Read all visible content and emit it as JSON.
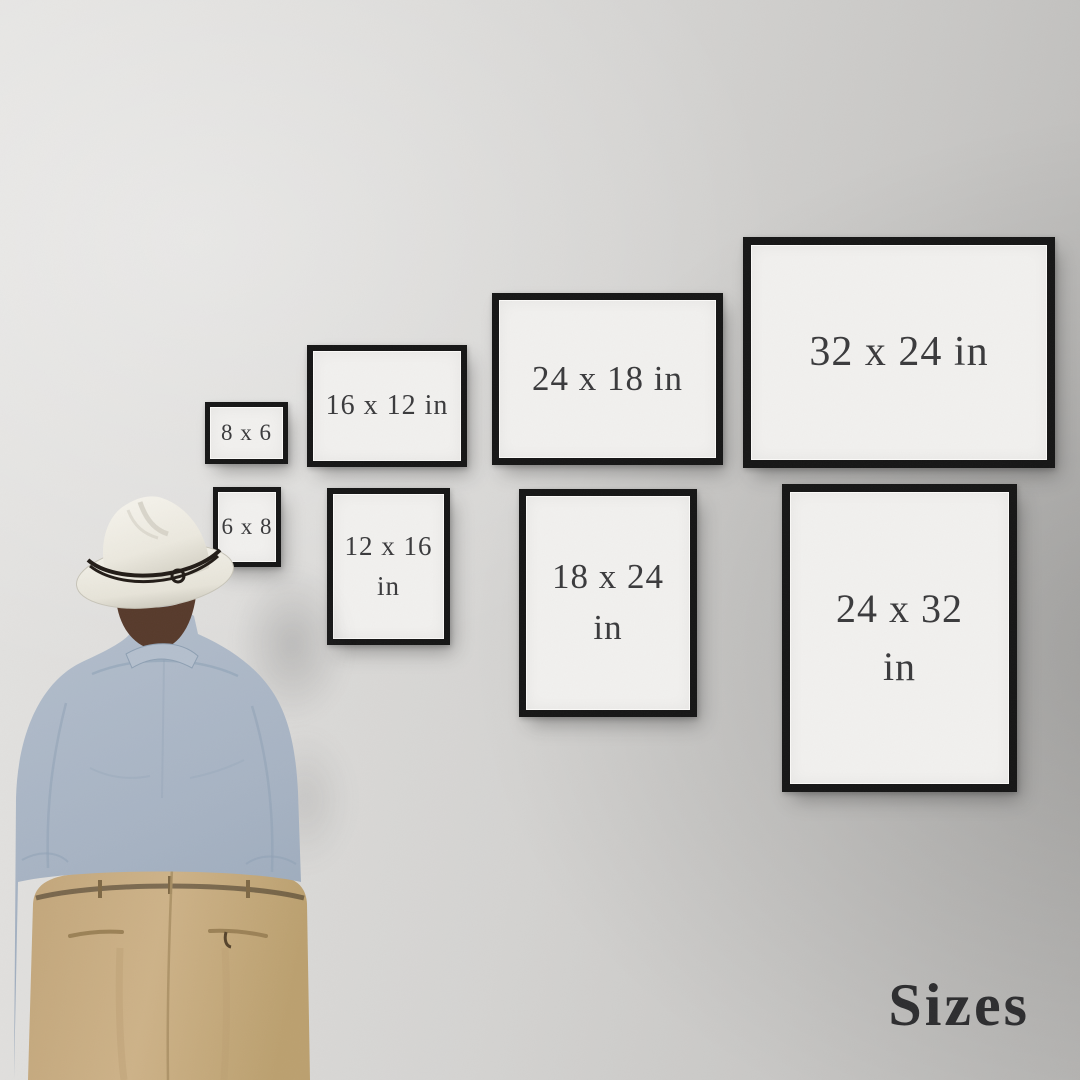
{
  "page": {
    "title": "Sizes"
  },
  "frames": [
    {
      "id": "8x6",
      "orientation": "landscape",
      "row": "top",
      "line1": "8 x 6",
      "line2": ""
    },
    {
      "id": "16x12",
      "orientation": "landscape",
      "row": "top",
      "line1": "16 x 12 in",
      "line2": ""
    },
    {
      "id": "24x18",
      "orientation": "landscape",
      "row": "top",
      "line1": "24 x 18 in",
      "line2": ""
    },
    {
      "id": "32x24",
      "orientation": "landscape",
      "row": "top",
      "line1": "32 x 24 in",
      "line2": ""
    },
    {
      "id": "6x8",
      "orientation": "portrait",
      "row": "bottom",
      "line1": "6 x 8",
      "line2": ""
    },
    {
      "id": "12x16",
      "orientation": "portrait",
      "row": "bottom",
      "line1": "12 x 16",
      "line2": "in"
    },
    {
      "id": "18x24",
      "orientation": "portrait",
      "row": "bottom",
      "line1": "18 x 24",
      "line2": "in"
    },
    {
      "id": "24x32",
      "orientation": "portrait",
      "row": "bottom",
      "line1": "24 x 32",
      "line2": "in"
    }
  ],
  "colors": {
    "wall_light": "#e4e3e1",
    "wall_dark": "#b9b8b6",
    "frame_border": "#161616",
    "frame_mat": "#f1f0ee",
    "label_text": "#3a3a3c",
    "title_text": "#2d2d2f",
    "shirt": "#a7b3c3",
    "trousers": "#c7ab81",
    "hat": "#efece3",
    "hat_band": "#221c17",
    "hair": "#573a2b"
  }
}
